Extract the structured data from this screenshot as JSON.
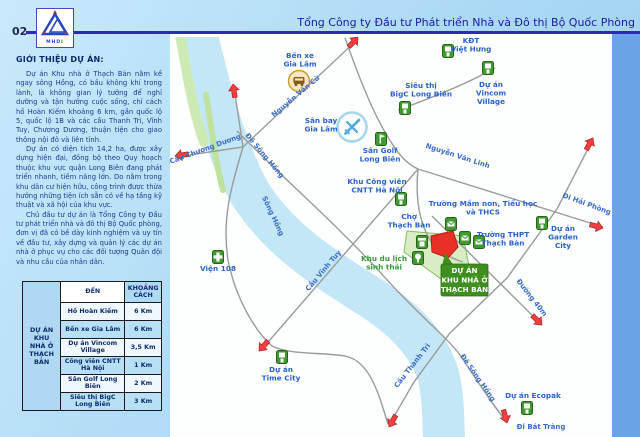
{
  "page": {
    "number": "02",
    "logo_text": "MHDI",
    "title": "Tổng Công ty Đầu tư Phát triển Nhà và Đô thị Bộ Quốc Phòng"
  },
  "intro": {
    "heading": "GIỚI THIỆU DỰ ÁN:",
    "paragraphs": [
      "Dự án Khu nhà ở Thạch Bàn nằm kề ngay sông Hồng, có bầu không khí trong lành, là không gian lý tưởng để nghỉ dưỡng và tận hưởng cuộc sống, chỉ cách hồ Hoàn Kiếm khoảng 6 km, gần quốc lộ 5, quốc lộ 1B và các cầu Thanh Trì, Vĩnh Tuy, Chương Dương, thuận tiện cho giao thông nội đô và liên tỉnh.",
      "Dự án có diện tích 14,2 ha, được xây dựng hiện đại, đồng bộ theo Quy hoạch thuộc khu vực quận Long Biên đang phát triển nhanh, tiềm năng lớn. Do nằm trong khu dân cư hiện hữu, công trình được thừa hưởng những tiện ích sẵn có về hạ tầng kỹ thuật và xã hội của khu vực.",
      "Chủ đầu tư dự án là Tổng Công ty Đầu tư phát triển nhà và đô thị Bộ Quốc phòng, đơn vị đã có bề dày kinh nghiệm và uy tín về đầu tư, xây dựng và quản lý các dự án nhà ở phục vụ cho các đối tượng Quân đội và nhu cầu của nhân dân."
    ]
  },
  "distance_table": {
    "project_label": "DỰ ÁN\nKHU NHÀ Ở\nTHẠCH BÀN",
    "col_dest": "ĐẾN",
    "col_dist": "KHOẢNG CÁCH",
    "rows": [
      [
        "Hồ Hoàn Kiếm",
        "6 Km"
      ],
      [
        "Bến xe Gia Lâm",
        "6 Km"
      ],
      [
        "Dự án Vincom Village",
        "3,5 Km"
      ],
      [
        "Công viên CNTT Hà Nội",
        "1 Km"
      ],
      [
        "Sân Golf Long Biên",
        "2 Km"
      ],
      [
        "Siêu thị BigC Long Biên",
        "3 Km"
      ]
    ]
  },
  "map": {
    "colors": {
      "water": "#c3e7f7",
      "road": "#9b9b9b",
      "label_blue": "#2b62c9",
      "label_green": "#3a9a3a",
      "arrow": "#ee4040",
      "site_red": "#e73127",
      "callout_green": "#3f8f1f",
      "marker_green": "#3f9b2f",
      "band_blue": "#6aa4e6"
    },
    "river": {
      "d": "M195,28 C210,90 222,140 248,190 C275,235 315,262 362,292 C405,318 430,345 439,378 C444,403 443,423 444,437",
      "width": 42
    },
    "green_strips": [
      {
        "d": "M179,30 C187,70 191,105 204,142",
        "color": "#cdeab4",
        "width": 10
      },
      {
        "d": "M206,95 C212,130 215,160 223,190",
        "color": "#bfe39e",
        "width": 6
      }
    ],
    "eco_zone": {
      "d": "M407,231 L463,236 L469,266 L441,279 L404,252 Z",
      "fill": "#d9edc5",
      "stroke": "#85bf5f"
    },
    "roads": [
      {
        "name": "cau-chuong-duong",
        "d": "M176,157 L243,147 L358,39"
      },
      {
        "name": "north-spur",
        "d": "M234,87 L243,147"
      },
      {
        "name": "west-bank-road",
        "d": "M243,147 C230,190 222,220 228,260 C236,300 256,332 272,346 C290,355 320,352 345,356 C365,360 375,382 383,408 L388,424"
      },
      {
        "name": "cau-vinh-tuy",
        "d": "M262,349 L367,228 L418,169"
      },
      {
        "name": "airport-road",
        "d": "M345,38 C360,80 372,110 385,132 C398,155 407,164 418,169"
      },
      {
        "name": "nguyen-van-linh",
        "d": "M418,169 L603,227"
      },
      {
        "name": "ring-road-cau-thanh-tri",
        "d": "M592,141 L557,209 L507,278 L450,333 L414,382 L389,425"
      },
      {
        "name": "de-song-hong",
        "d": "M237,131 C290,185 330,218 380,272 C415,312 448,338 460,355 C478,382 495,408 506,421"
      },
      {
        "name": "duong-40m",
        "d": "M432,216 L541,324"
      },
      {
        "name": "bigc-vincom-road",
        "d": "M398,110 C440,95 470,82 495,68"
      },
      {
        "name": "thach-ban-local-road",
        "d": "M418,169 C415,200 420,225 432,243 C440,252 450,258 463,262"
      }
    ],
    "arrows": [
      {
        "name": "arrow-north",
        "x": 233,
        "y": 84,
        "a": -8
      },
      {
        "name": "arrow-nguyen-van-cu",
        "x": 358,
        "y": 37,
        "a": 43
      },
      {
        "name": "arrow-cau-chuong-duong",
        "x": 175,
        "y": 156,
        "a": 262
      },
      {
        "name": "arrow-cau-vinh-tuy",
        "x": 259,
        "y": 351,
        "a": 222
      },
      {
        "name": "arrow-cau-thanh-tri-end",
        "x": 389,
        "y": 427,
        "a": 210
      },
      {
        "name": "arrow-duong-40m",
        "x": 542,
        "y": 325,
        "a": 135
      },
      {
        "name": "arrow-ring-road-north",
        "x": 593,
        "y": 138,
        "a": 30
      },
      {
        "name": "arrow-di-hai-phong",
        "x": 603,
        "y": 228,
        "a": 105
      },
      {
        "name": "arrow-di-bat-trang",
        "x": 507,
        "y": 423,
        "a": 165
      }
    ],
    "road_labels": [
      {
        "name": "label-cau-chuong-duong",
        "t": "Cầu Chương Dương",
        "x": 206,
        "y": 151,
        "r": -20
      },
      {
        "name": "label-nguyen-van-cu",
        "t": "Nguyễn Văn Cừ",
        "x": 297,
        "y": 98,
        "r": -40
      },
      {
        "name": "label-de-song-hong-top",
        "t": "Đê Sông Hồng",
        "x": 263,
        "y": 157,
        "r": 50
      },
      {
        "name": "label-song-hong",
        "t": "Sông Hồng",
        "x": 271,
        "y": 217,
        "r": 65
      },
      {
        "name": "label-cau-vinh-tuy",
        "t": "Cầu Vĩnh Tuy",
        "x": 325,
        "y": 272,
        "r": -50
      },
      {
        "name": "label-nguyen-van-linh",
        "t": "Nguyễn Văn Linh",
        "x": 457,
        "y": 158,
        "r": 18
      },
      {
        "name": "label-di-hai-phong",
        "t": "Đi Hải Phòng",
        "x": 586,
        "y": 206,
        "r": 20
      },
      {
        "name": "label-cau-thanh-tri",
        "t": "Cầu Thanh Trì",
        "x": 414,
        "y": 367,
        "r": -52
      },
      {
        "name": "label-de-song-hong-bottom",
        "t": "Đê Sông Hồng",
        "x": 476,
        "y": 379,
        "r": 55
      },
      {
        "name": "label-duong-40m",
        "t": "Đường 40m",
        "x": 530,
        "y": 299,
        "r": 52
      },
      {
        "name": "label-di-bat-trang",
        "t": "Đi Bát Tràng",
        "x": 541,
        "y": 429,
        "r": 0
      }
    ],
    "place_labels": [
      {
        "name": "label-ben-xe-gia-lam",
        "t": "Bến xe\nGia Lâm",
        "x": 300,
        "y": 58
      },
      {
        "name": "label-san-bay-gia-lam",
        "t": "Sân bay\nGia Lâm",
        "x": 321,
        "y": 123
      },
      {
        "name": "label-kdt-viet-hung",
        "t": "KĐT\nViệt Hưng",
        "x": 471,
        "y": 43
      },
      {
        "name": "label-sieu-thi-bigc",
        "t": "Siêu thị\nBigC Long Biên",
        "x": 421,
        "y": 88
      },
      {
        "name": "label-vincom-village",
        "t": "Dự án\nVincom\nVillage",
        "x": 491,
        "y": 87
      },
      {
        "name": "label-san-golf",
        "t": "Sân Golf\nLong Biên",
        "x": 380,
        "y": 153
      },
      {
        "name": "label-cong-vien-cntt",
        "t": "Khu Công viên\nCNTT Hà Nội",
        "x": 377,
        "y": 184
      },
      {
        "name": "label-cho-thach-ban",
        "t": "Chợ\nThạch Bàn",
        "x": 409,
        "y": 219
      },
      {
        "name": "label-truong-mam-non",
        "t": "Trường Mầm non, Tiểu học\nvà THCS",
        "x": 483,
        "y": 206
      },
      {
        "name": "label-truong-thpt",
        "t": "Trường THPT\nThạch Bàn",
        "x": 503,
        "y": 237
      },
      {
        "name": "label-garden-city",
        "t": "Dự án\nGarden\nCity",
        "x": 563,
        "y": 231
      },
      {
        "name": "label-vien-108",
        "t": "Viện 108",
        "x": 218,
        "y": 271
      },
      {
        "name": "label-khu-du-lich",
        "t": "Khu du lịch\nsinh thái",
        "x": 384,
        "y": 261,
        "cls": "glbl"
      },
      {
        "name": "label-time-city",
        "t": "Dự án\nTime City",
        "x": 281,
        "y": 372
      },
      {
        "name": "label-ecopak",
        "t": "Dự án Ecopak",
        "x": 533,
        "y": 398
      }
    ],
    "markers": [
      {
        "type": "bus",
        "name": "ben-xe-gia-lam-icon",
        "x": 299,
        "y": 81
      },
      {
        "type": "plane",
        "name": "san-bay-gia-lam-icon",
        "x": 352,
        "y": 127
      },
      {
        "type": "building",
        "name": "kdt-viet-hung-icon",
        "x": 448,
        "y": 51
      },
      {
        "type": "building",
        "name": "vincom-village-icon",
        "x": 488,
        "y": 68
      },
      {
        "type": "building",
        "name": "bigc-icon",
        "x": 405,
        "y": 108
      },
      {
        "type": "golf",
        "name": "san-golf-icon",
        "x": 381,
        "y": 139
      },
      {
        "type": "building",
        "name": "cong-vien-cntt-icon",
        "x": 401,
        "y": 199
      },
      {
        "type": "market",
        "name": "cho-thach-ban-icon",
        "x": 422,
        "y": 242
      },
      {
        "type": "school",
        "name": "mam-non-icon",
        "x": 451,
        "y": 224
      },
      {
        "type": "school",
        "name": "tieu-hoc-icon",
        "x": 465,
        "y": 238
      },
      {
        "type": "school",
        "name": "thpt-thach-ban-icon",
        "x": 479,
        "y": 242
      },
      {
        "type": "building",
        "name": "garden-city-icon",
        "x": 542,
        "y": 223
      },
      {
        "type": "hospital",
        "name": "vien-108-icon",
        "x": 218,
        "y": 257
      },
      {
        "type": "tree",
        "name": "khu-du-lich-icon",
        "x": 418,
        "y": 258
      },
      {
        "type": "building",
        "name": "time-city-icon",
        "x": 282,
        "y": 357
      },
      {
        "type": "building",
        "name": "ecopak-icon",
        "x": 527,
        "y": 408
      }
    ],
    "site": {
      "d": "M431,236 L453,231 L458,247 L448,258 L432,252 Z"
    },
    "callout": {
      "lines": [
        "DỰ ÁN",
        "KHU NHÀ Ở",
        "THẠCH BÀN"
      ],
      "x": 441,
      "y": 264,
      "w": 47,
      "h": 32,
      "tail": "M442,266 L454,266 L445,253 Z"
    }
  }
}
